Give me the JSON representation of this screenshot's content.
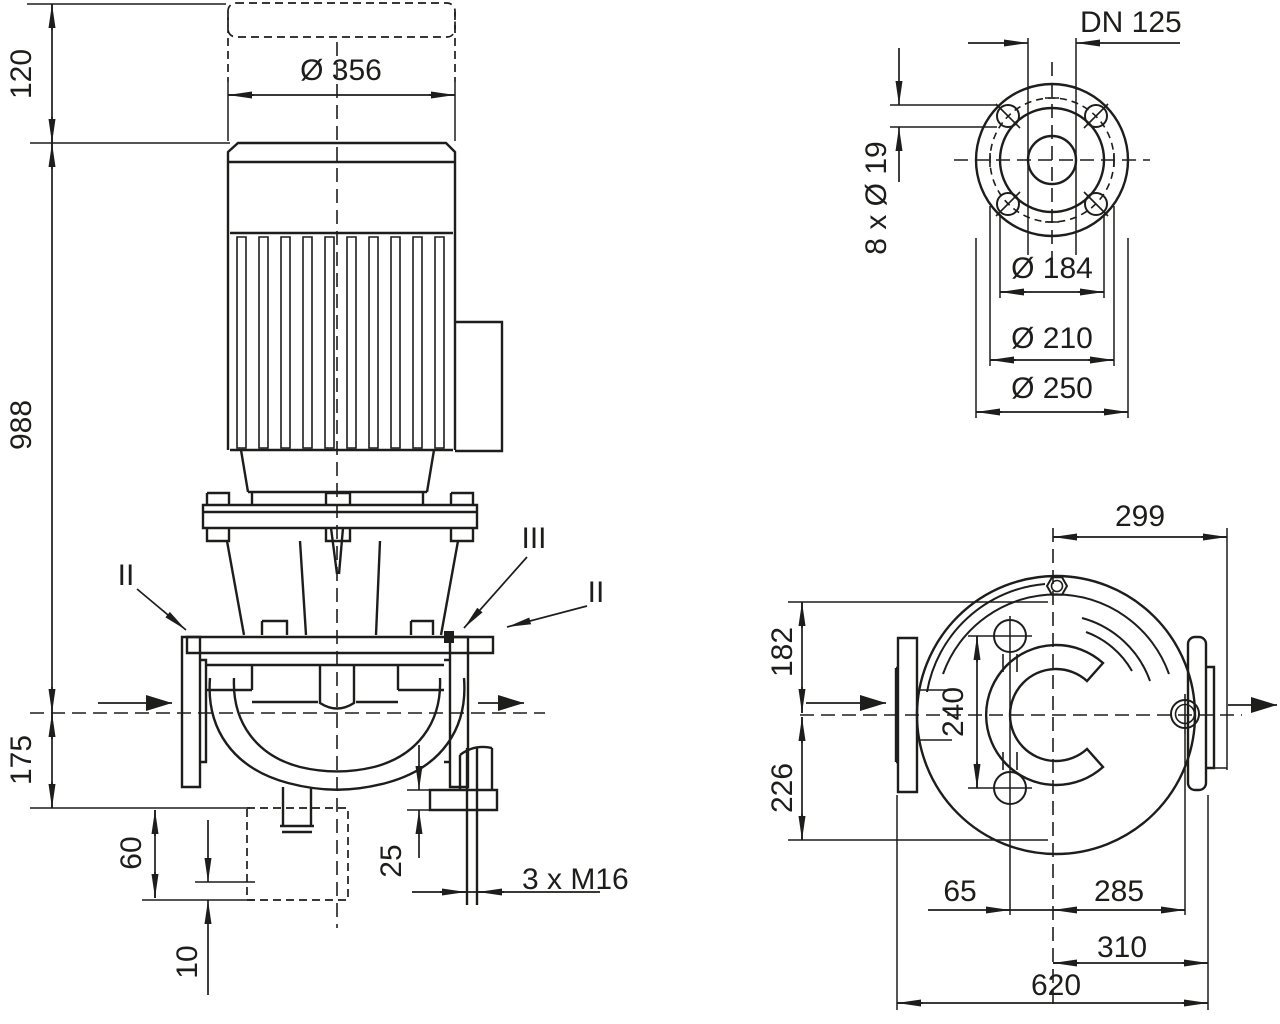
{
  "background_color": "#ffffff",
  "line_color": "#1d1d1b",
  "side_view": {
    "clearance_top": "120",
    "overall_height": "988",
    "center_to_base": "175",
    "base_to_foundation": "60",
    "foundation_depth": "10",
    "foot_plate_thickness": "25",
    "motor_diameter": "Ø 356",
    "anchor_studs": "3 x M16",
    "section_left": "II",
    "section_center": "III",
    "section_right": "II"
  },
  "flange_view": {
    "nominal_diameter": "DN 125",
    "bolt_holes": "8 x Ø 19",
    "raised_face_diameter": "Ø 184",
    "bolt_circle_diameter": "Ø 210",
    "outer_diameter": "Ø 250"
  },
  "plan_view": {
    "center_to_discharge_flange": "299",
    "center_to_top": "182",
    "center_to_bottom": "226",
    "foot_hole_spacing": "240",
    "hole_offset": "65",
    "center_to_suction_face": "285",
    "center_to_discharge_face": "310",
    "overall_length": "620"
  }
}
